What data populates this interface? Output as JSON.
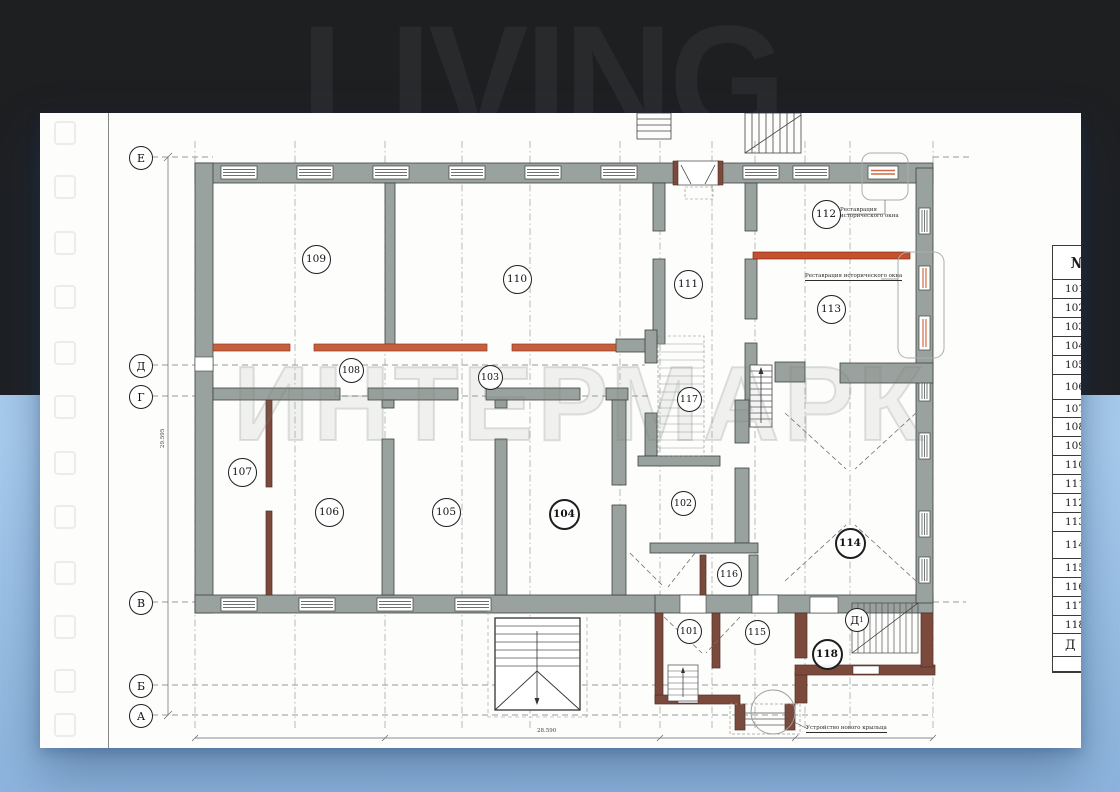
{
  "watermarks": {
    "top": "LIVING",
    "plan": "ИНТЕРМАРК"
  },
  "grid_axes": [
    {
      "label": "Е",
      "x": 100,
      "y": 44
    },
    {
      "label": "Д",
      "x": 100,
      "y": 252
    },
    {
      "label": "Г",
      "x": 100,
      "y": 283
    },
    {
      "label": "В",
      "x": 100,
      "y": 489
    },
    {
      "label": "Б",
      "x": 100,
      "y": 572
    },
    {
      "label": "А",
      "x": 100,
      "y": 602
    },
    {
      "label": "Д",
      "sub": "1",
      "x": 816,
      "y": 506
    }
  ],
  "rooms": [
    {
      "num": "109",
      "x": 275,
      "y": 145
    },
    {
      "num": "110",
      "x": 476,
      "y": 165
    },
    {
      "num": "111",
      "x": 647,
      "y": 170
    },
    {
      "num": "112",
      "x": 785,
      "y": 100
    },
    {
      "num": "113",
      "x": 790,
      "y": 195
    },
    {
      "num": "108",
      "x": 310,
      "y": 256,
      "small": true
    },
    {
      "num": "103",
      "x": 449,
      "y": 263,
      "small": true
    },
    {
      "num": "117",
      "x": 648,
      "y": 285,
      "small": true
    },
    {
      "num": "107",
      "x": 201,
      "y": 358
    },
    {
      "num": "106",
      "x": 288,
      "y": 398
    },
    {
      "num": "105",
      "x": 405,
      "y": 398
    },
    {
      "num": "104",
      "x": 522,
      "y": 399,
      "bold": true
    },
    {
      "num": "102",
      "x": 642,
      "y": 389,
      "small": true
    },
    {
      "num": "114",
      "x": 808,
      "y": 428,
      "bold": true
    },
    {
      "num": "116",
      "x": 688,
      "y": 460,
      "small": true
    },
    {
      "num": "101",
      "x": 648,
      "y": 517,
      "small": true
    },
    {
      "num": "115",
      "x": 716,
      "y": 518,
      "small": true
    },
    {
      "num": "118",
      "x": 785,
      "y": 539,
      "bold": true
    }
  ],
  "annotations": {
    "restore_line1": "Реставрация",
    "restore_line2": "исторического окна",
    "restore_full": "Реставрация исторического окна",
    "new_porch": "Устройство нового крыльца",
    "dim_bottom": "28.590",
    "dim_left": "29.595"
  },
  "table": {
    "header": "№",
    "rows": [
      {
        "label": "101",
        "h": 18
      },
      {
        "label": "102",
        "h": 18
      },
      {
        "label": "103",
        "h": 18
      },
      {
        "label": "104",
        "h": 18
      },
      {
        "label": "105",
        "h": 18
      },
      {
        "label": "106",
        "h": 24
      },
      {
        "label": "107",
        "h": 17
      },
      {
        "label": "108",
        "h": 18
      },
      {
        "label": "109",
        "h": 18
      },
      {
        "label": "110",
        "h": 18
      },
      {
        "label": "111",
        "h": 18
      },
      {
        "label": "112",
        "h": 18
      },
      {
        "label": "113",
        "h": 18
      },
      {
        "label": "114",
        "h": 26
      },
      {
        "label": "115",
        "h": 18
      },
      {
        "label": "116",
        "h": 18
      },
      {
        "label": "117",
        "h": 18
      },
      {
        "label": "118",
        "h": 17
      },
      {
        "label": "Д",
        "h": 22,
        "big": true
      },
      {
        "label": "",
        "h": 14
      }
    ]
  },
  "colors": {
    "dark_bg": "#1e1f21",
    "blue_bg": "#a9cdee",
    "wall_gray": "#9aa29f",
    "brown": "#7c4a3d",
    "orange": "#c65f3d",
    "red_wall": "#c4502e"
  }
}
